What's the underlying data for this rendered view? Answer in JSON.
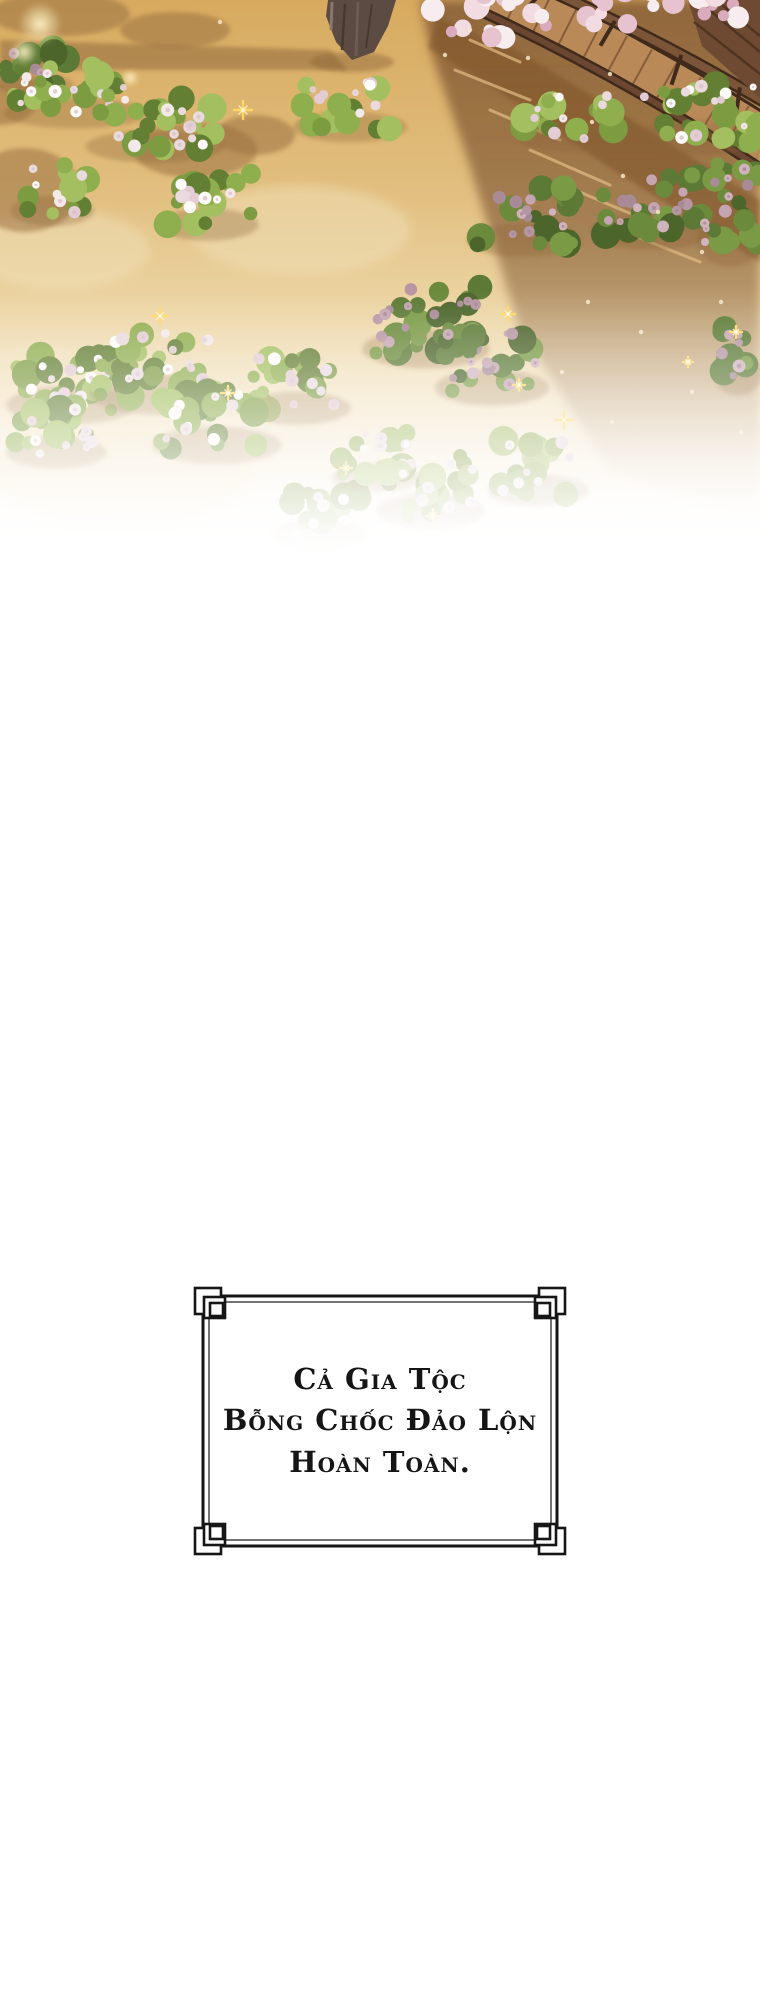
{
  "page": {
    "background": "#ffffff",
    "width": 760,
    "height": 2000
  },
  "caption_box": {
    "lines": [
      "Cả gia tộc",
      "bỗng chốc đảo lộn",
      "hoàn toàn."
    ],
    "border_color": "#161616",
    "text_color": "#151515",
    "background": "#ffffff"
  },
  "scene": {
    "type": "illustration",
    "palette": {
      "sand_stops": [
        "#d7aa5f",
        "#e1bd7d",
        "#ecd5a4",
        "#f8efdd",
        "#ffffff"
      ],
      "shadow_brown": "#7d5430",
      "dapple_brown": "#9c7243",
      "tree_shadow": "#8a6338",
      "trunk": "#5c4b43",
      "trunk_dark": "#463731",
      "trunk_light": "#8a766a",
      "wood_dark": "#402a1b",
      "wood_mid": "#7b5537",
      "wood_deck": "#b98a57",
      "wood_plank": "#7e5536",
      "sparkle_gold": "#ffd666",
      "petal_cream": "#f6e7c9",
      "glow_yellow": "#fff3c4",
      "greens": {
        "lit": [
          "#7d9c42",
          "#8fae4e",
          "#a3bf5f",
          "#637f33"
        ],
        "shade": [
          "#5c7a35",
          "#6b8a3c",
          "#7a9a45",
          "#4c652b"
        ],
        "faint": [
          "#9bb25f",
          "#a9bf6e",
          "#b7cb7d",
          "#8aa14f"
        ]
      },
      "flowers": {
        "lit": [
          "#f2e9e8",
          "#e9dade",
          "#fdfbf8",
          "#e3ccd4"
        ],
        "shade": [
          "#c4a5b0",
          "#b696a3",
          "#d0b4bd",
          "#a98b98"
        ],
        "faint": [
          "#f4ebe9",
          "#eadfe2",
          "#f9f4f2",
          "#e8d6db"
        ]
      },
      "flower_centers": {
        "lit": "#d9c2c9",
        "shade": "#a58894",
        "faint": "#ddc9cf"
      },
      "blossom_pink": [
        "#f2dce2",
        "#e7c3cf",
        "#d9abbc",
        "#f7ecee"
      ]
    },
    "sand_patches": [
      {
        "x": 60,
        "y": 250,
        "rx": 90,
        "ry": 40
      },
      {
        "x": 120,
        "y": 470,
        "rx": 130,
        "ry": 60
      },
      {
        "x": 40,
        "y": 380,
        "rx": 70,
        "ry": 35
      },
      {
        "x": 300,
        "y": 230,
        "rx": 110,
        "ry": 45
      }
    ],
    "right_shadow_pts": "420,0 760,0 760,520 610,470 520,330 468,160 432,55",
    "tree_shadow_pts": "0,40 330,50 348,70 0,70",
    "walk_shadow_pts": "438,18 520,52 640,125 760,200 760,262 610,168 500,92 428,48",
    "dapples": [
      {
        "x": 60,
        "y": 14,
        "rx": 70,
        "ry": 22
      },
      {
        "x": 175,
        "y": 30,
        "rx": 55,
        "ry": 18
      },
      {
        "x": 25,
        "y": 190,
        "rx": 55,
        "ry": 42
      },
      {
        "x": 195,
        "y": 150,
        "rx": 62,
        "ry": 28
      },
      {
        "x": 255,
        "y": 135,
        "rx": 40,
        "ry": 20
      },
      {
        "x": 0,
        "y": 95,
        "rx": 40,
        "ry": 30
      }
    ],
    "streaks": [
      [
        455,
        70,
        530,
        100
      ],
      [
        490,
        110,
        560,
        140
      ],
      [
        530,
        150,
        610,
        185
      ],
      [
        575,
        190,
        650,
        222
      ],
      [
        620,
        230,
        700,
        262
      ],
      [
        470,
        40,
        520,
        62
      ]
    ],
    "trunk_pts": "328,0 396,0 388,26 374,52 352,60 336,42 326,16",
    "walkway": {
      "rail1": {
        "p0": [
          512,
          -26
        ],
        "p1": [
          652,
          34
        ],
        "p2": [
          768,
          104
        ]
      },
      "deck": {
        "p0": [
          492,
          -8
        ],
        "p1": [
          638,
          60
        ],
        "p2": [
          766,
          142
        ]
      },
      "rail2": {
        "p0": [
          478,
          10
        ],
        "p1": [
          628,
          80
        ],
        "p2": [
          760,
          168
        ]
      },
      "plank_t": [
        0.08,
        0.17,
        0.26,
        0.35,
        0.44,
        0.53,
        0.62,
        0.71,
        0.8,
        0.89
      ],
      "post_t": [
        0.12,
        0.38,
        0.64,
        0.88
      ],
      "corner_pts": "688,0 760,0 760,98 702,46",
      "corner_lines": [
        [
          702,
          4,
          760,
          52
        ],
        [
          716,
          0,
          760,
          36
        ],
        [
          694,
          22,
          760,
          74
        ]
      ]
    },
    "blossom_clusters": [
      {
        "x": 428,
        "y": -6,
        "w": 120,
        "h": 44,
        "n": 16
      },
      {
        "x": 585,
        "y": -10,
        "w": 90,
        "h": 34,
        "n": 12
      },
      {
        "x": 700,
        "y": -6,
        "w": 58,
        "h": 26,
        "n": 8
      }
    ],
    "bushes": [
      {
        "x": 0,
        "y": 46,
        "w": 70,
        "h": 44,
        "v": "shade"
      },
      {
        "x": 10,
        "y": 62,
        "w": 132,
        "h": 58,
        "v": "lit"
      },
      {
        "x": 92,
        "y": 92,
        "w": 126,
        "h": 62,
        "v": "lit"
      },
      {
        "x": 298,
        "y": 76,
        "w": 104,
        "h": 58,
        "v": "lit"
      },
      {
        "x": 14,
        "y": 160,
        "w": 76,
        "h": 58,
        "v": "lit"
      },
      {
        "x": 162,
        "y": 170,
        "w": 92,
        "h": 62,
        "v": "lit"
      },
      {
        "x": 520,
        "y": 88,
        "w": 100,
        "h": 56,
        "v": "lit"
      },
      {
        "x": 636,
        "y": 80,
        "w": 126,
        "h": 66,
        "v": "lit"
      },
      {
        "x": 472,
        "y": 182,
        "w": 104,
        "h": 66,
        "v": "shade"
      },
      {
        "x": 596,
        "y": 170,
        "w": 112,
        "h": 70,
        "v": "shade"
      },
      {
        "x": 700,
        "y": 148,
        "w": 60,
        "h": 104,
        "v": "shade"
      },
      {
        "x": 12,
        "y": 340,
        "w": 118,
        "h": 74,
        "v": "lit"
      },
      {
        "x": 96,
        "y": 326,
        "w": 128,
        "h": 78,
        "v": "lit"
      },
      {
        "x": 158,
        "y": 382,
        "w": 118,
        "h": 72,
        "v": "lit"
      },
      {
        "x": 10,
        "y": 398,
        "w": 92,
        "h": 62,
        "v": "lit"
      },
      {
        "x": 250,
        "y": 352,
        "w": 96,
        "h": 64,
        "v": "lit"
      },
      {
        "x": 368,
        "y": 282,
        "w": 116,
        "h": 76,
        "v": "shade"
      },
      {
        "x": 440,
        "y": 326,
        "w": 104,
        "h": 70,
        "v": "shade"
      },
      {
        "x": 716,
        "y": 300,
        "w": 44,
        "h": 84,
        "v": "shade"
      },
      {
        "x": 276,
        "y": 482,
        "w": 86,
        "h": 60,
        "v": "faint"
      },
      {
        "x": 382,
        "y": 452,
        "w": 98,
        "h": 68,
        "v": "faint"
      },
      {
        "x": 492,
        "y": 436,
        "w": 92,
        "h": 62,
        "v": "faint"
      },
      {
        "x": 336,
        "y": 428,
        "w": 80,
        "h": 56,
        "v": "faint"
      }
    ],
    "sparkles": [
      {
        "x": 243,
        "y": 110,
        "s": 9
      },
      {
        "x": 160,
        "y": 316,
        "s": 8
      },
      {
        "x": 228,
        "y": 393,
        "s": 7
      },
      {
        "x": 508,
        "y": 314,
        "s": 7
      },
      {
        "x": 519,
        "y": 385,
        "s": 6
      },
      {
        "x": 564,
        "y": 420,
        "s": 8
      },
      {
        "x": 433,
        "y": 516,
        "s": 7
      },
      {
        "x": 346,
        "y": 468,
        "s": 6
      },
      {
        "x": 736,
        "y": 332,
        "s": 6
      },
      {
        "x": 688,
        "y": 362,
        "s": 5
      }
    ],
    "petals": [
      [
        555,
        95
      ],
      [
        592,
        122
      ],
      [
        623,
        176
      ],
      [
        658,
        212
      ],
      [
        702,
        252
      ],
      [
        588,
        302
      ],
      [
        641,
        332
      ],
      [
        721,
        302
      ],
      [
        692,
        392
      ],
      [
        612,
        422
      ],
      [
        562,
        372
      ],
      [
        741,
        432
      ],
      [
        528,
        58
      ],
      [
        610,
        74
      ],
      [
        470,
        30
      ],
      [
        445,
        55
      ],
      [
        220,
        22
      ]
    ],
    "glows": [
      {
        "x": 40,
        "y": 24,
        "r": 22
      },
      {
        "x": 24,
        "y": 52,
        "r": 14
      },
      {
        "x": 130,
        "y": 78,
        "r": 9
      }
    ]
  }
}
